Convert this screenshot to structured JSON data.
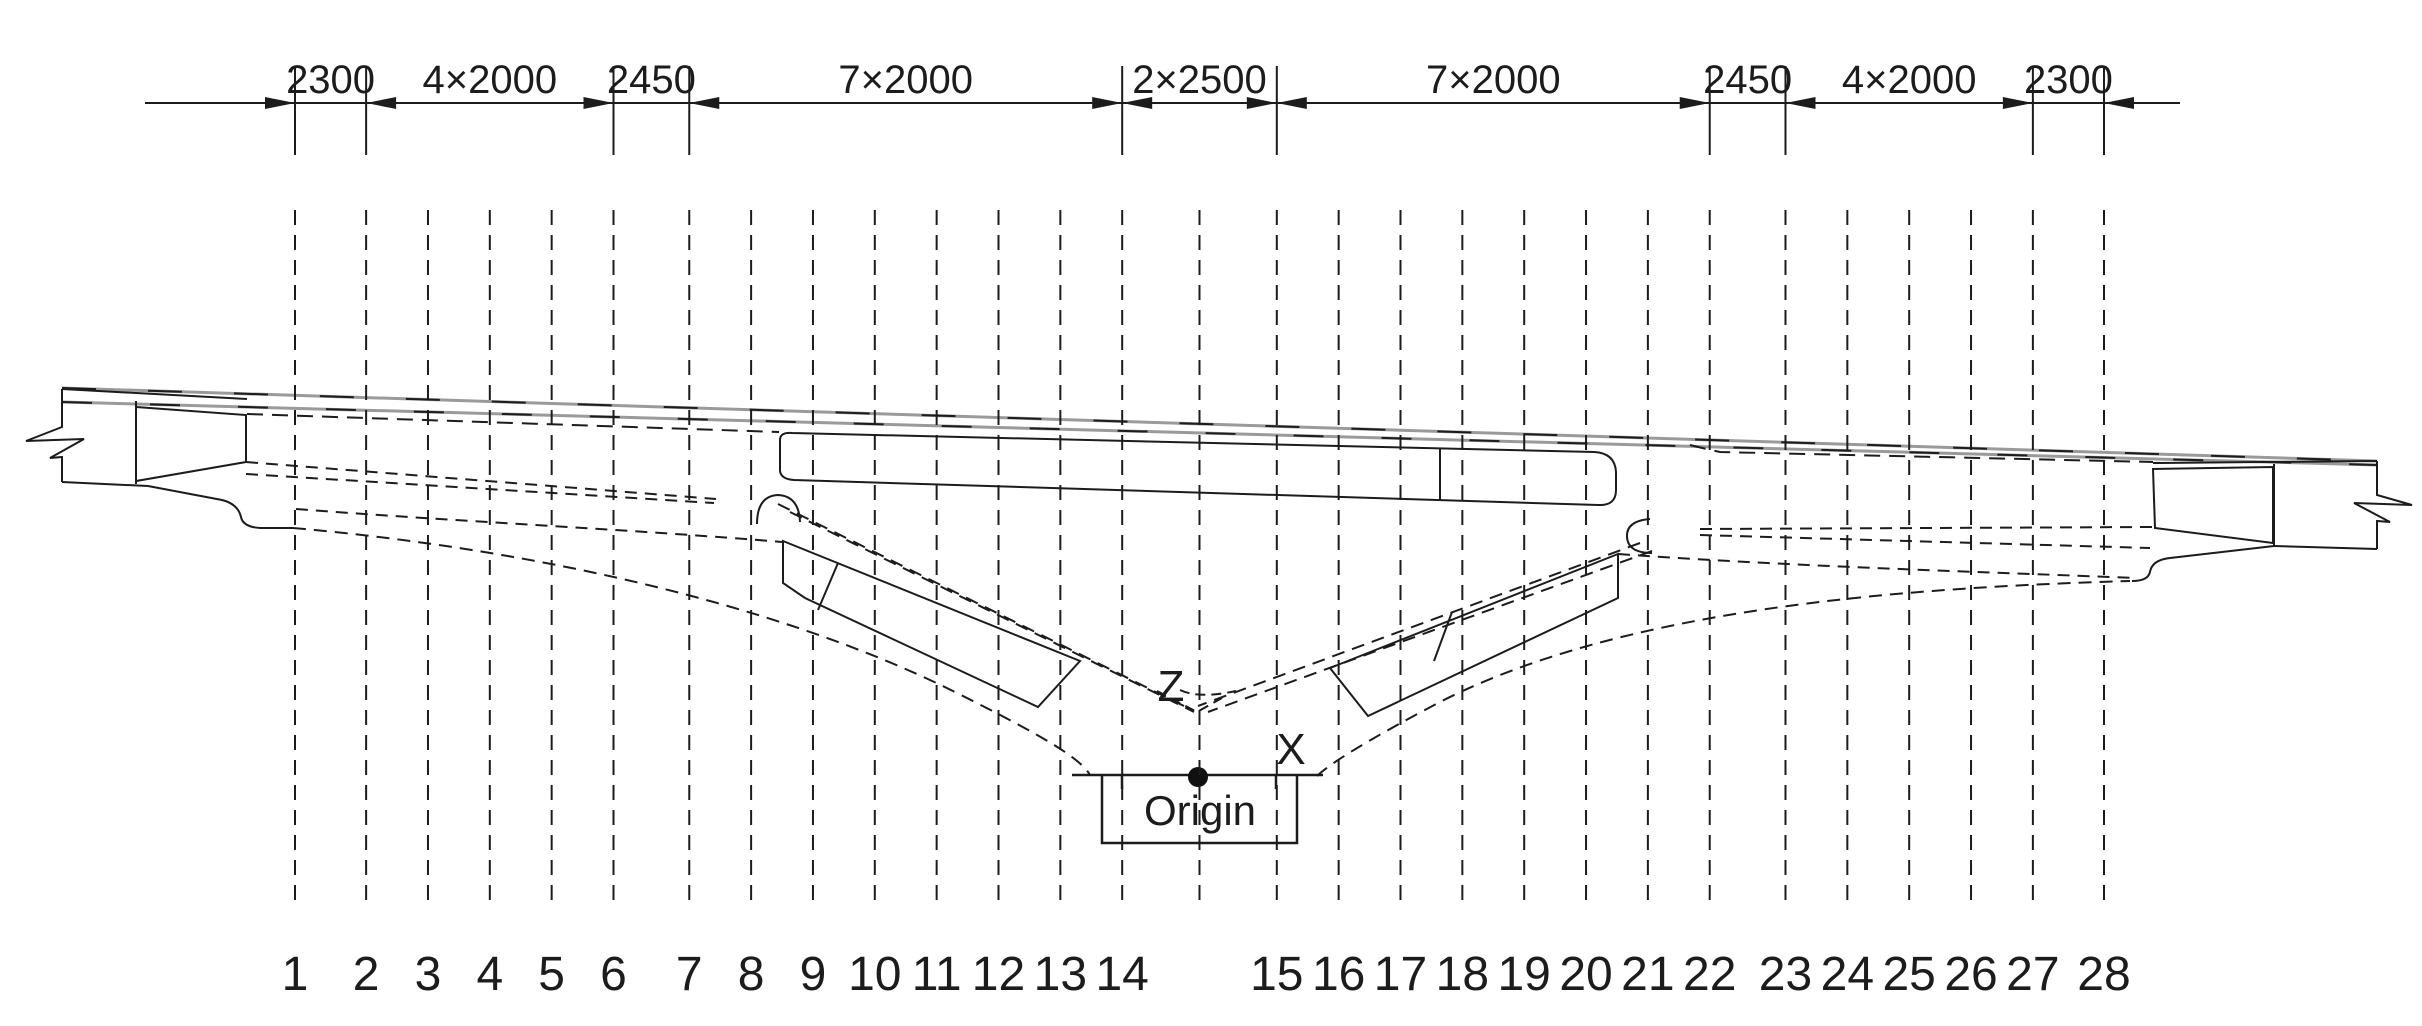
{
  "drawing": {
    "type": "bridge-elevation-section-layout",
    "origin_label": "Origin",
    "axis_labels": {
      "z": "Z",
      "x": "X"
    },
    "dimension_segments": [
      {
        "label": "2300",
        "span_mm": 2300
      },
      {
        "label": "4×2000",
        "span_mm": 8000
      },
      {
        "label": "2450",
        "span_mm": 2450
      },
      {
        "label": "7×2000",
        "span_mm": 14000
      },
      {
        "label": "2×2500",
        "span_mm": 5000
      },
      {
        "label": "7×2000",
        "span_mm": 14000
      },
      {
        "label": "2450",
        "span_mm": 2450
      },
      {
        "label": "4×2000",
        "span_mm": 8000
      },
      {
        "label": "2300",
        "span_mm": 2300
      }
    ],
    "total_length_mm": 58500,
    "sections": [
      {
        "label": "1",
        "station_mm": 0
      },
      {
        "label": "2",
        "station_mm": 2300
      },
      {
        "label": "3",
        "station_mm": 4300
      },
      {
        "label": "4",
        "station_mm": 6300
      },
      {
        "label": "5",
        "station_mm": 8300
      },
      {
        "label": "6",
        "station_mm": 10300
      },
      {
        "label": "7",
        "station_mm": 12750
      },
      {
        "label": "8",
        "station_mm": 14750
      },
      {
        "label": "9",
        "station_mm": 16750
      },
      {
        "label": "10",
        "station_mm": 18750
      },
      {
        "label": "11",
        "station_mm": 20750
      },
      {
        "label": "12",
        "station_mm": 22750
      },
      {
        "label": "13",
        "station_mm": 24750
      },
      {
        "label": "14",
        "station_mm": 26750
      },
      {
        "label": "",
        "station_mm": 29250
      },
      {
        "label": "15",
        "station_mm": 31750
      },
      {
        "label": "16",
        "station_mm": 33750
      },
      {
        "label": "17",
        "station_mm": 35750
      },
      {
        "label": "18",
        "station_mm": 37750
      },
      {
        "label": "19",
        "station_mm": 39750
      },
      {
        "label": "20",
        "station_mm": 41750
      },
      {
        "label": "21",
        "station_mm": 43750
      },
      {
        "label": "22",
        "station_mm": 45750
      },
      {
        "label": "23",
        "station_mm": 48200
      },
      {
        "label": "24",
        "station_mm": 50200
      },
      {
        "label": "25",
        "station_mm": 52200
      },
      {
        "label": "26",
        "station_mm": 54200
      },
      {
        "label": "27",
        "station_mm": 56200
      },
      {
        "label": "28",
        "station_mm": 58500
      }
    ],
    "colors": {
      "line": "#1c1c1c",
      "deck_gray": "#9a9a9a",
      "background": "#ffffff"
    }
  }
}
